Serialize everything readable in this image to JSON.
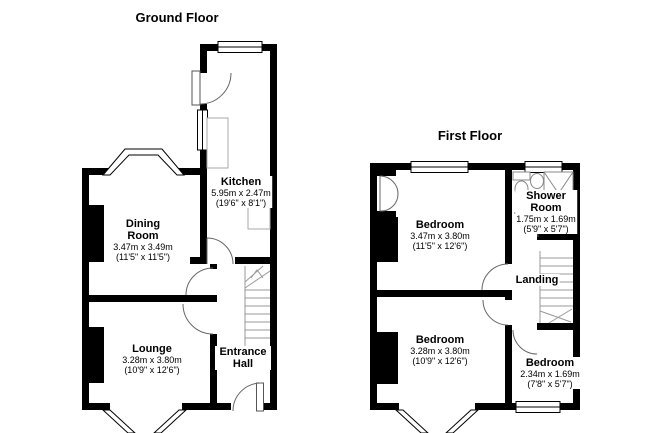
{
  "document": {
    "type": "property-floorplan",
    "background": "#ffffff",
    "colors": {
      "wall": "#000000",
      "detail_line": "#888888",
      "stairs_line": "#999999",
      "text": "#000000"
    }
  },
  "ground_floor": {
    "title": "Ground Floor",
    "rooms": [
      {
        "name": "Kitchen",
        "metric": "5.95m x 2.47m",
        "imperial": "(19'6\" x 8'1\")"
      },
      {
        "name": "Dining Room",
        "metric": "3.47m x 3.49m",
        "imperial": "(11'5\" x 11'5\")"
      },
      {
        "name": "Lounge",
        "metric": "3.28m x 3.80m",
        "imperial": "(10'9\" x 12'6\")"
      },
      {
        "name": "Entrance Hall"
      }
    ],
    "symbols": [
      "stairs-up",
      "bay-window",
      "back-door",
      "front-door",
      "kitchen-counter",
      "chimney-breast"
    ]
  },
  "first_floor": {
    "title": "First Floor",
    "rooms": [
      {
        "name": "Bedroom",
        "metric": "3.47m x 3.80m",
        "imperial": "(11'5\" x 12'6\")"
      },
      {
        "name": "Shower Room",
        "metric": "1.75m x 1.69m",
        "imperial": "(5'9\" x 5'7\")"
      },
      {
        "name": "Landing"
      },
      {
        "name": "Bedroom",
        "metric": "3.28m x 3.80m",
        "imperial": "(10'9\" x 12'6\")"
      },
      {
        "name": "Bedroom",
        "metric": "2.34m x 1.69m",
        "imperial": "(7'8\" x 5'7\")"
      }
    ],
    "symbols": [
      "stairs-down",
      "shower-cubicle",
      "toilet",
      "basin",
      "cupboard-double-doors",
      "bay-window",
      "chimney-breast"
    ]
  }
}
